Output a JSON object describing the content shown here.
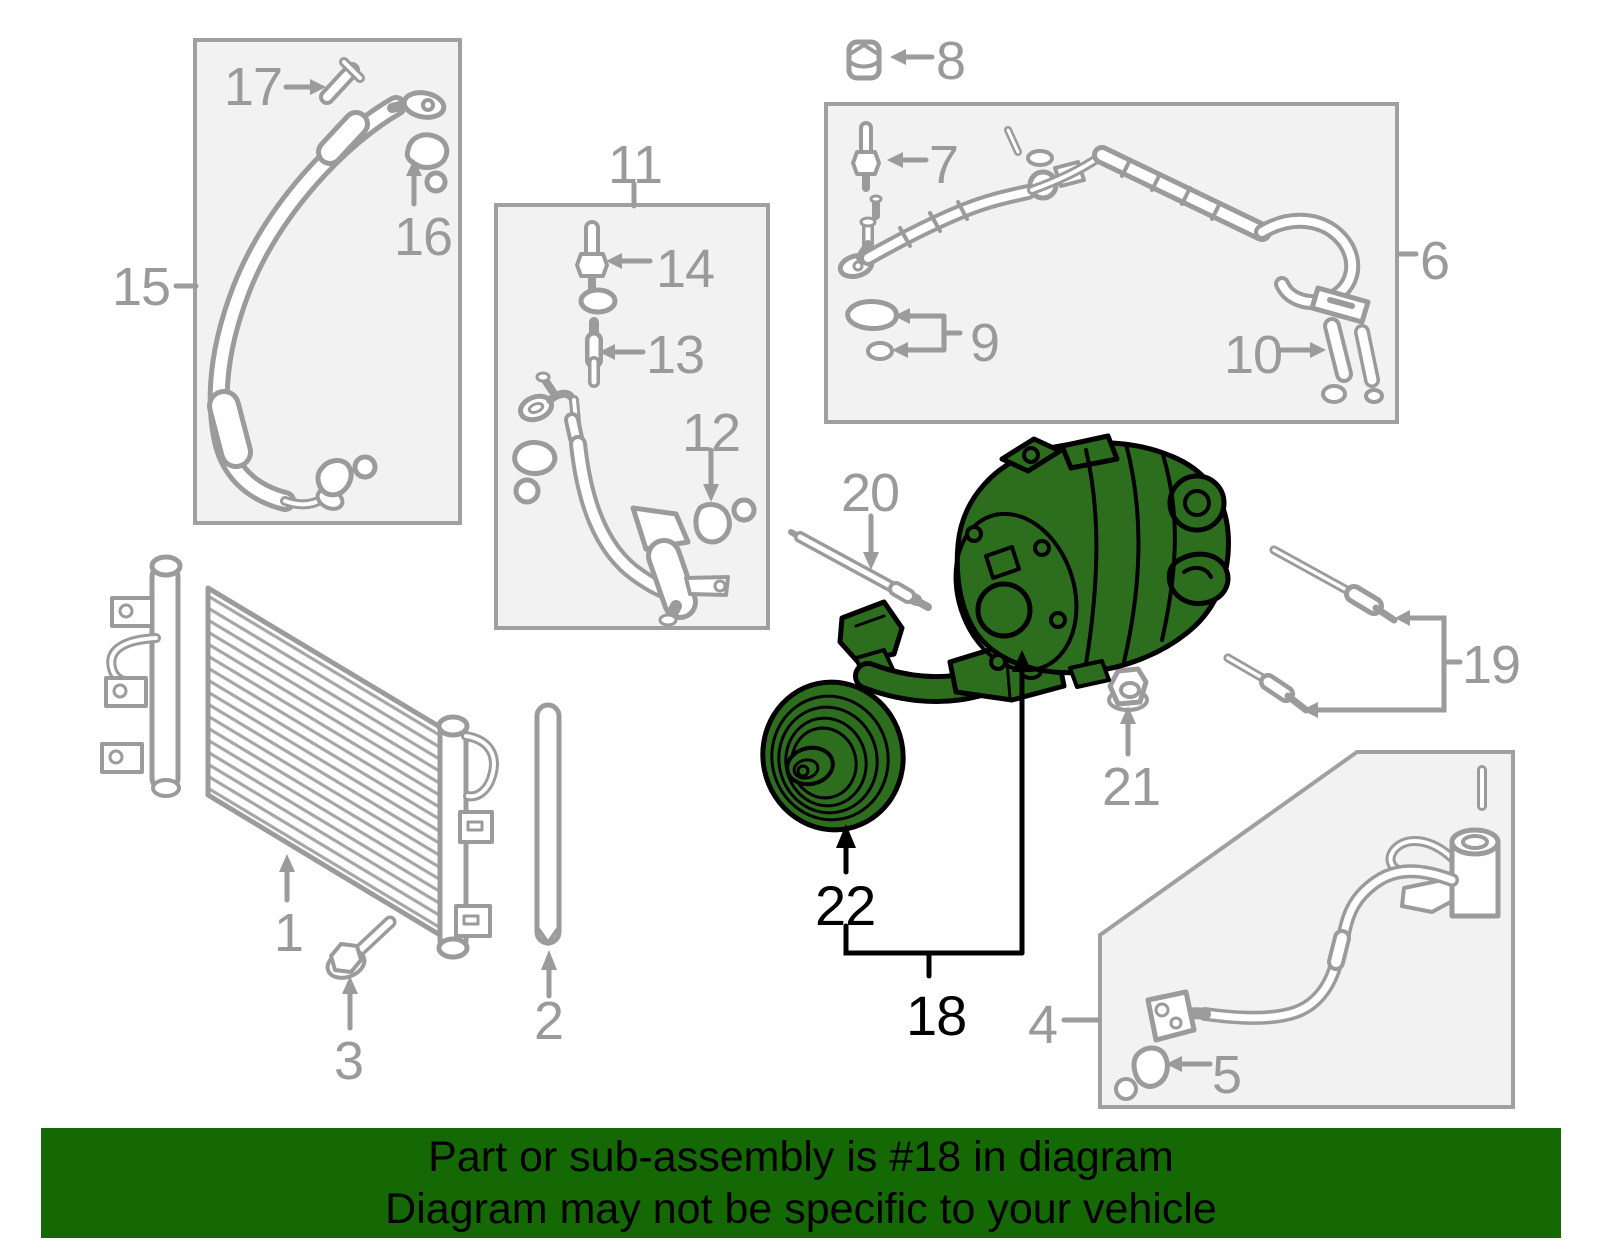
{
  "diagram": {
    "kind": "automotive-ac-parts-diagram",
    "highlighted_parts": [
      "18",
      "22"
    ]
  },
  "colors": {
    "highlight_green": "#2d6e1e",
    "banner_background": "#146904",
    "line_gray": "#9b9b9b",
    "box_fill": "#f2f2f2",
    "label_gray": "#9a9a9a",
    "label_black": "#000000"
  },
  "icons": {
    "callout_arrow": "triangle-arrow",
    "callout_bracket": "right-angle-bracket-line"
  },
  "labels": {
    "p1": "1",
    "p2": "2",
    "p3": "3",
    "p4": "4",
    "p5": "5",
    "p6": "6",
    "p7": "7",
    "p8": "8",
    "p9": "9",
    "p10": "10",
    "p11": "11",
    "p12": "12",
    "p13": "13",
    "p14": "14",
    "p15": "15",
    "p16": "16",
    "p17": "17",
    "p18": "18",
    "p19": "19",
    "p20": "20",
    "p21": "21",
    "p22": "22"
  },
  "banner": {
    "line1": "Part or sub-assembly is #18 in diagram",
    "line2": "Diagram may not be specific to your vehicle"
  }
}
